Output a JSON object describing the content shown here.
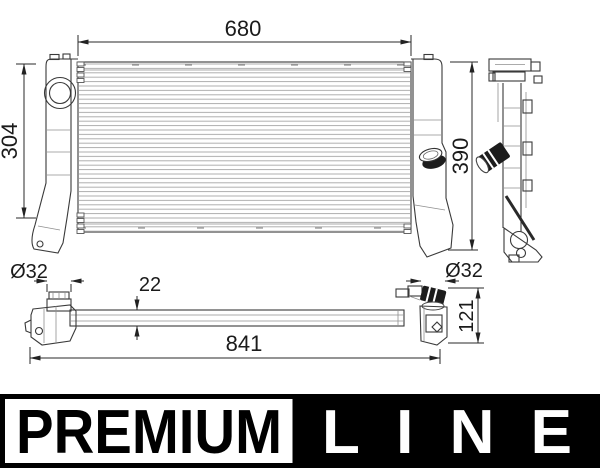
{
  "drawing": {
    "dims": {
      "width_top": "680",
      "height_left": "304",
      "height_right": "390",
      "diameter_left": "Ø32",
      "core_depth": "22",
      "diameter_right": "Ø32",
      "connector_height": "121",
      "overall_length": "841"
    }
  },
  "logo": {
    "premium": "PREMIUM",
    "line": "LINE"
  },
  "colors": {
    "ink": "#3a3a3a",
    "fins": "#b0b0b0",
    "logo_black": "#000000",
    "logo_white": "#ffffff"
  }
}
